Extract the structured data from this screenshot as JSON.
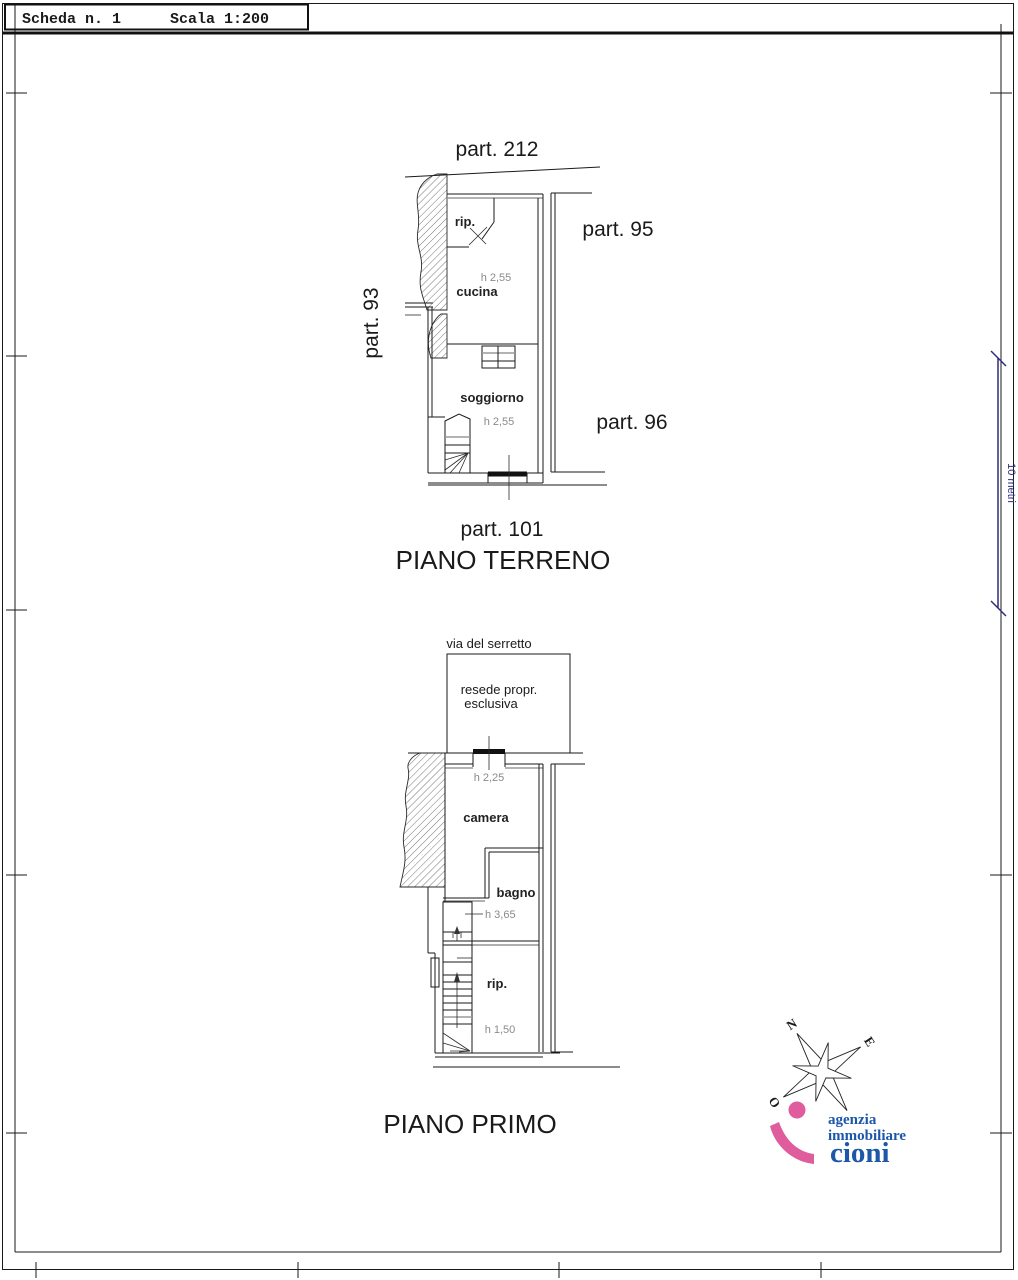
{
  "sheet": {
    "scheda": "Scheda n. 1",
    "scala": "Scala 1:200"
  },
  "ground_floor": {
    "title": "PIANO TERRENO",
    "parcel_top": "part. 212",
    "parcel_left": "part. 93",
    "parcel_right_upper": "part. 95",
    "parcel_right_lower": "part. 96",
    "parcel_bottom": "part. 101",
    "rooms": {
      "rip": "rip.",
      "cucina": "cucina",
      "cucina_height": "h 2,55",
      "soggiorno": "soggiorno",
      "soggiorno_height": "h 2,55"
    }
  },
  "first_floor": {
    "title": "PIANO PRIMO",
    "street": "via del serretto",
    "courtyard_line1": "resede propr.",
    "courtyard_line2": "esclusiva",
    "entry_height": "h 2,25",
    "rooms": {
      "camera": "camera",
      "bagno": "bagno",
      "bagno_height": "h 3,65",
      "rip": "rip.",
      "rip_height": "h 1,50"
    }
  },
  "scale_bar": {
    "label": "10 metri"
  },
  "compass": {
    "north": "N",
    "east": "E",
    "west": "O"
  },
  "logo": {
    "line1": "agenzia",
    "line2": "immobiliare",
    "line3": "cioni"
  },
  "colors": {
    "plan_ink": "#1a1a1a",
    "logo_pink": "#df5c9d",
    "logo_blue": "#1d57a8",
    "scale_bar": "#2e2e7a"
  }
}
